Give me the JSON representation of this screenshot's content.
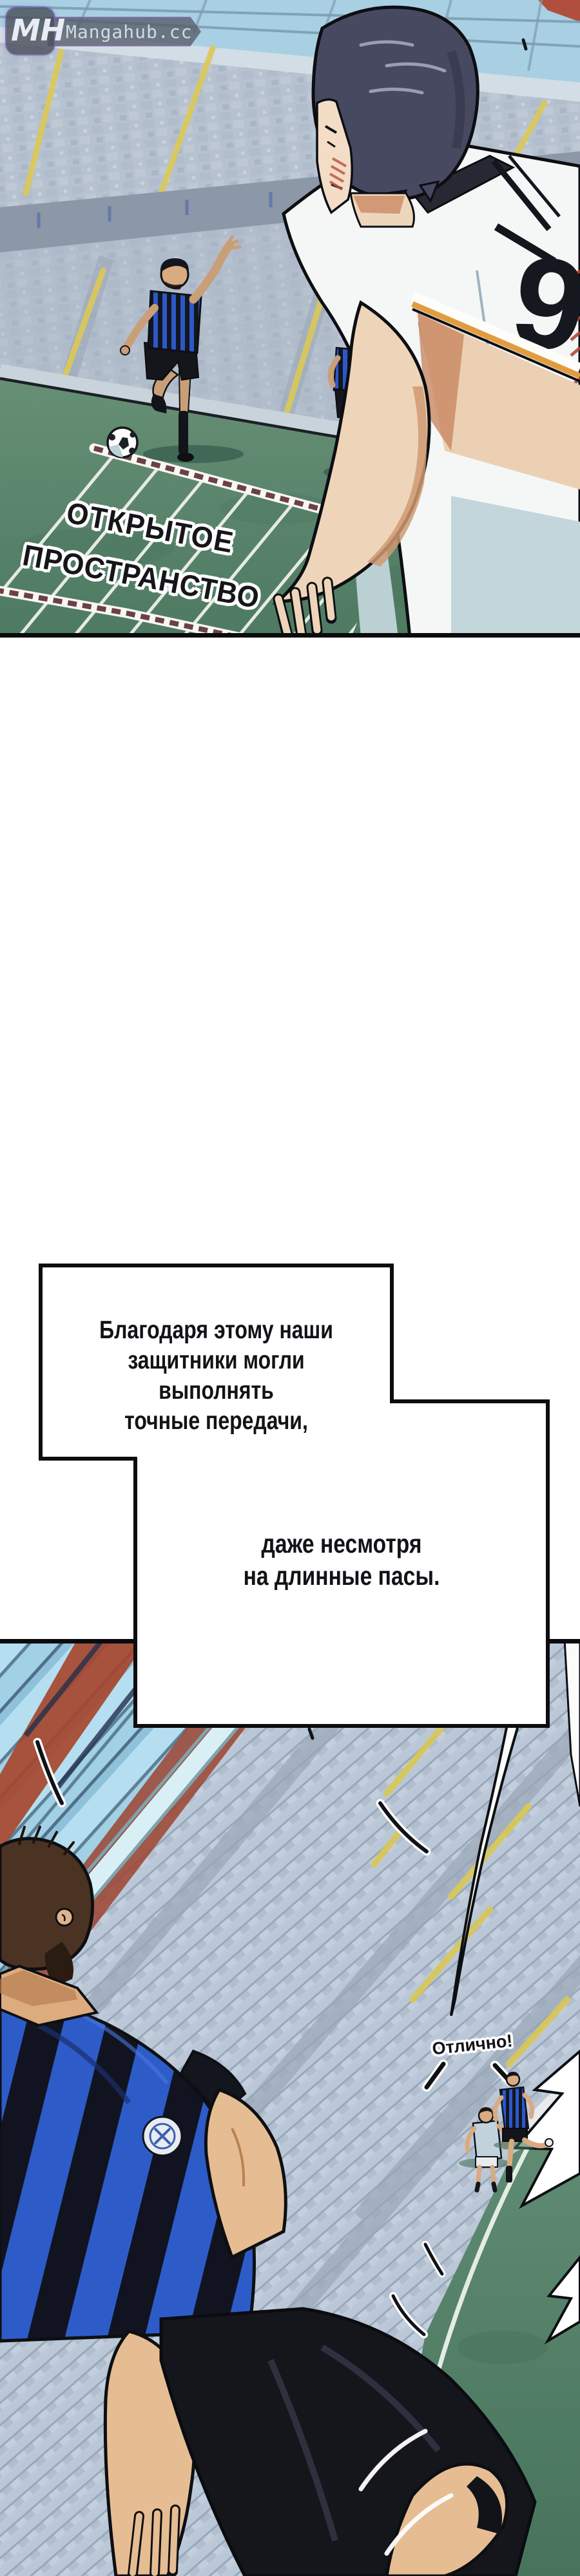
{
  "watermark": {
    "initials": "MH",
    "site": "Mangahub.cc"
  },
  "panel1": {
    "field_zone_label": [
      "ОТКРЫТОЕ",
      "ПРОСТРАНСТВО"
    ],
    "jersey_number": "9"
  },
  "speech_bubble": {
    "paragraph1": [
      "Благодаря этому наши",
      "защитники могли выполнять",
      "точные передачи,"
    ],
    "paragraph2": [
      "даже несмотря",
      "на длинные пасы."
    ]
  },
  "panel2": {
    "shout": "Отлично!"
  },
  "palette": {
    "paper": "#ffffff",
    "ink": "#111116",
    "field_green": "#5e8b72",
    "field_shadow": "#4e7a62",
    "stands_grey": "#b7c2d0",
    "stair_yellow": "#dcc957",
    "team_blue": "#2c58c8",
    "stripe_black": "#14161f",
    "roof_glass": "#aacfe3",
    "truss_red": "#a6462f",
    "skin": "#eed5ba",
    "jersey_white": "#f5f7f7",
    "jersey_shade": "#c2d6dc"
  }
}
